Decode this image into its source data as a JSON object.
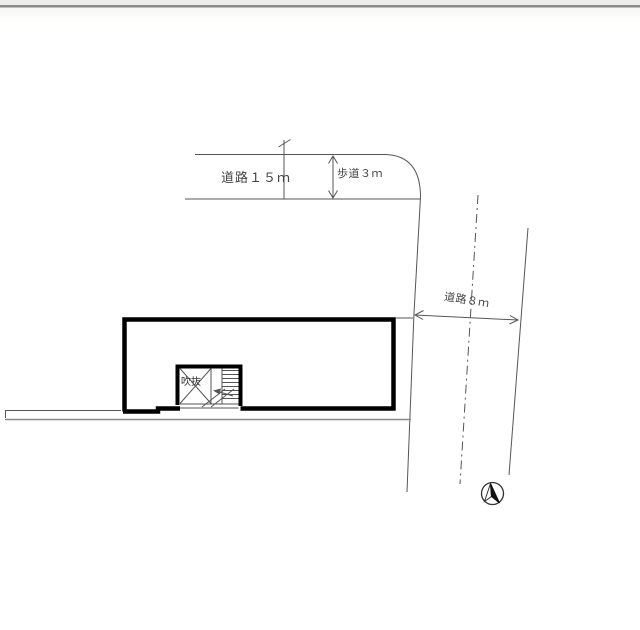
{
  "page": {
    "background": "#ffffff",
    "top_border_color": "#8a8a8a",
    "type": "architectural-site-plan"
  },
  "drawing": {
    "labels": {
      "road_top": "道路１５ｍ",
      "sidewalk": "歩道３ｍ",
      "road_right": "道路８ｍ",
      "void": "吹抜"
    },
    "colors": {
      "thin_line": "#555555",
      "wall_line": "#000000",
      "ground_line": "#888888",
      "text": "#444444",
      "north_needle": "#111111"
    },
    "icons": {
      "north_arrow": "compass-needle-icon"
    }
  }
}
